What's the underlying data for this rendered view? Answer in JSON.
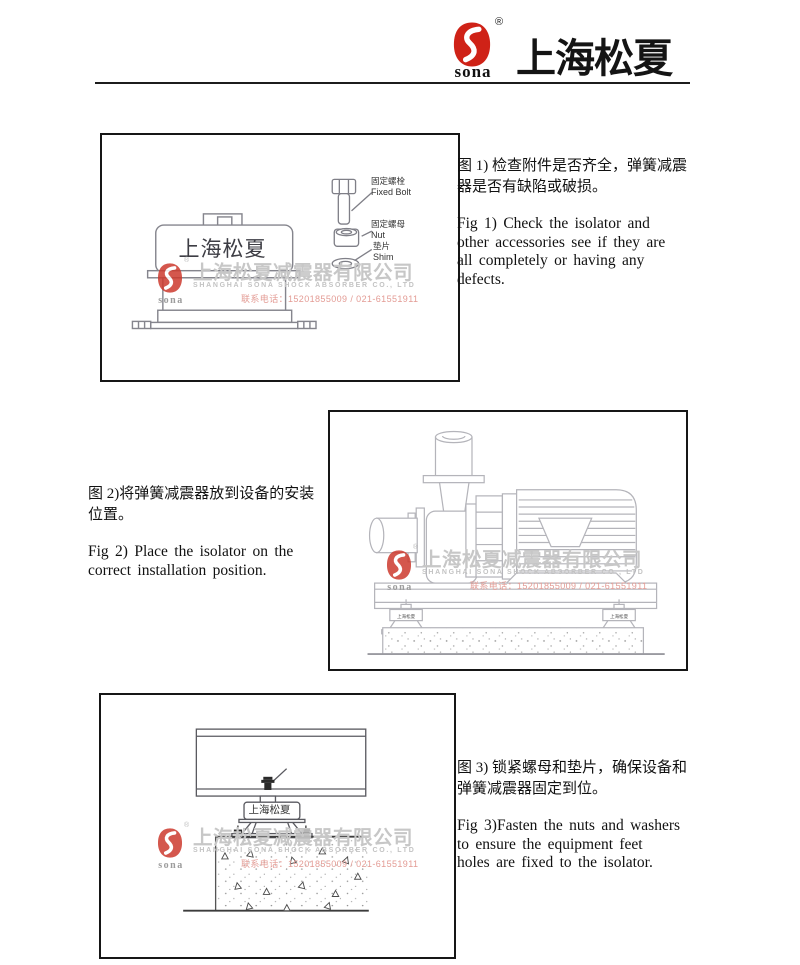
{
  "header": {
    "logo_text": "sona",
    "registered": "®",
    "brand_cn": "上海松夏"
  },
  "watermark": {
    "logo_text": "sona",
    "registered": "®",
    "company_cn": "上海松夏减震器有限公司",
    "company_en": "SHANGHAI SONA SHOCK ABSORBER CO., LTD",
    "phone": "联系电话：15201855009 / 021-61551911"
  },
  "figure1": {
    "device_label": "上海松夏",
    "parts": [
      {
        "cn": "固定螺栓",
        "en": "Fixed Bolt"
      },
      {
        "cn": "固定螺母",
        "en": "Nut"
      },
      {
        "cn": "垫片",
        "en": "Shim"
      }
    ],
    "caption_cn_lines": [
      "图 1) 检查附件是否齐全，弹簧减震",
      "器是否有缺陷或破损。"
    ],
    "caption_en_lines": [
      "Fig 1) Check the isolator and",
      "other accessories see if they are",
      "all completely or having any",
      "defects."
    ]
  },
  "figure2": {
    "isolator_label": "上海松夏",
    "caption_cn_lines": [
      "图 2)将弹簧减震器放到设备的安装",
      "位置。"
    ],
    "caption_en_lines": [
      "Fig 2) Place the isolator on the",
      "correct installation position."
    ]
  },
  "figure3": {
    "isolator_label": "上海松夏",
    "caption_cn_lines": [
      "图 3) 锁紧螺母和垫片，确保设备和",
      "弹簧减震器固定到位。"
    ],
    "caption_en_lines": [
      "Fig 3)Fasten the nuts and washers",
      "to ensure the equipment feet",
      "holes are fixed to the isolator."
    ]
  },
  "colors": {
    "brand_red": "#cf2217",
    "watermark_red": "#cd3a2e"
  }
}
